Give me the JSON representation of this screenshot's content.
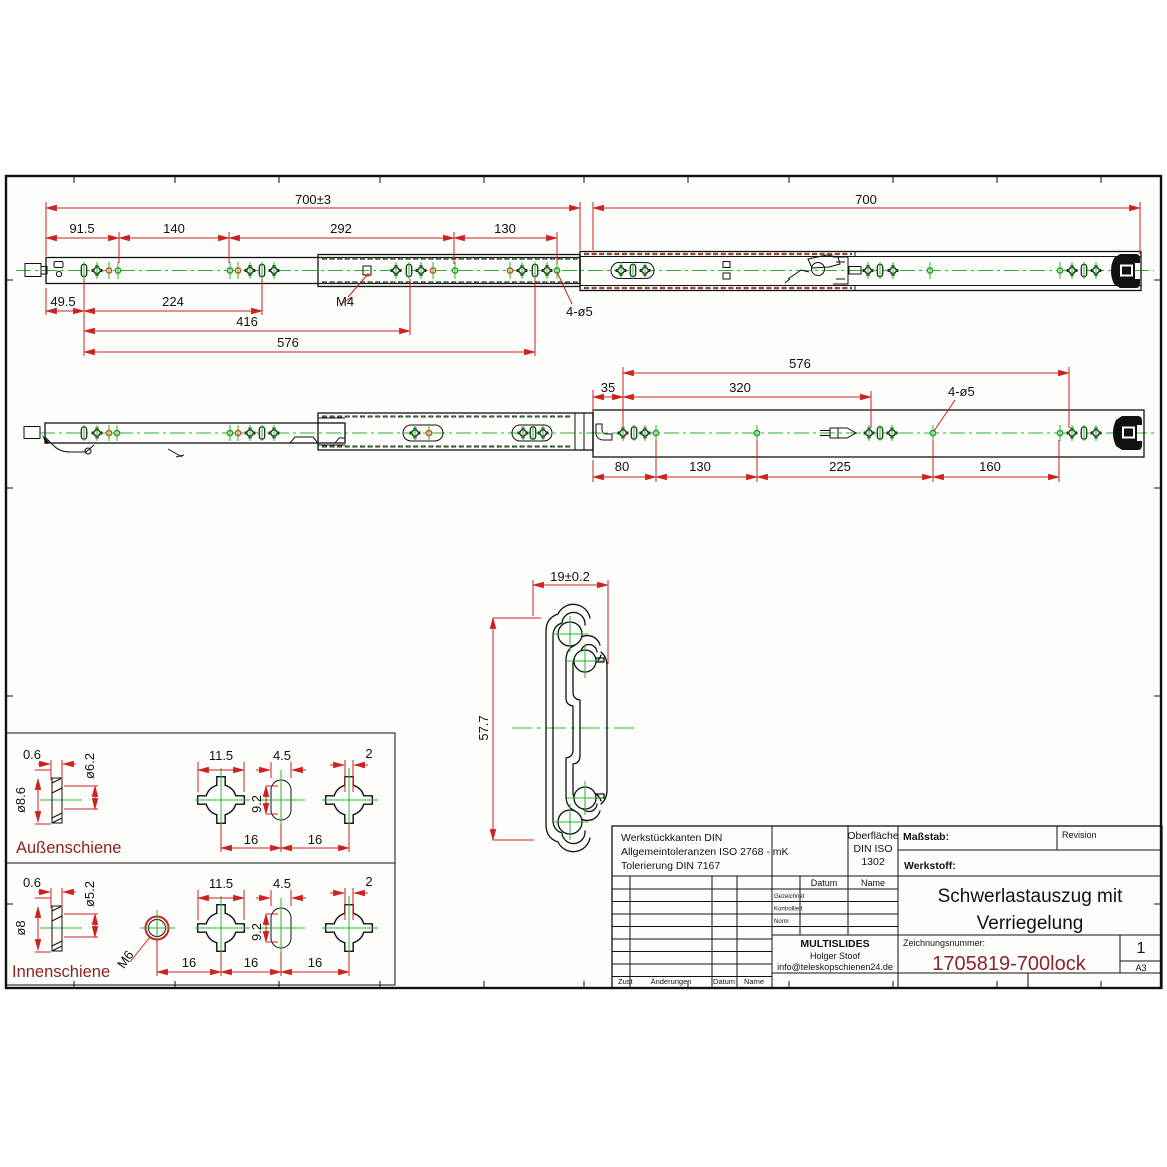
{
  "colors": {
    "dimension_red": "#cc2222",
    "centerline_green": "#2ab52a",
    "accent_maroon": "#8a2430",
    "email_teal": "#1a7f93"
  },
  "top_view": {
    "dim_total": "700±3",
    "dim_travel": "700",
    "seg1": "91.5",
    "seg2": "140",
    "seg3": "292",
    "seg4": "130",
    "low1": "49.5",
    "low2": "224",
    "low3": "416",
    "low4": "576",
    "thread_label": "M4",
    "holes_label": "4-ø5"
  },
  "mid_view": {
    "dim_576": "576",
    "dim_35": "35",
    "dim_320": "320",
    "holes_label": "4-ø5",
    "b80": "80",
    "b130": "130",
    "b225": "225",
    "b160": "160"
  },
  "section_view": {
    "width_dim": "19±0.2",
    "height_dim": "57.7"
  },
  "detail_aussen": {
    "label": "Außenschiene",
    "t06": "0.6",
    "d62": "ø6.2",
    "d86": "ø8.6",
    "w115": "11.5",
    "w45": "4.5",
    "w2": "2",
    "h92": "9.2",
    "s16a": "16",
    "s16b": "16"
  },
  "detail_innen": {
    "label": "Innenschiene",
    "t06": "0.6",
    "d52": "ø5.2",
    "d8": "ø8",
    "m6": "M6",
    "w115": "11.5",
    "w45": "4.5",
    "w2": "2",
    "h92": "9.2",
    "s16a": "16",
    "s16b": "16",
    "s16c": "16"
  },
  "title_block": {
    "tol1": "Werkstückkanten DIN",
    "tol2": "Allgemeintoleranzen ISO 2768 - mK",
    "tol3": "Tolerierung DIN 7167",
    "surf1": "Oberfläche",
    "surf2": "DIN ISO",
    "surf3": "1302",
    "masstab_label": "Maßstab:",
    "revision_label": "Revision",
    "werkstoff_label": "Werkstoff:",
    "datum_label": "Datum",
    "name_label": "Name",
    "row_gezeichnet": "Gezeichnet",
    "row_kontrolliert": "Kontrolliert",
    "row_norm": "Norm",
    "title_line1": "Schwerlastauszug mit",
    "title_line2": "Verriegelung",
    "company": "MULTISLIDES",
    "author": "Holger Stoof",
    "email": "info@teleskopschienen24.de",
    "zeichnungsnummer_label": "Zeichnungsnummer:",
    "drawing_number": "1705819-700lock",
    "sheet_number": "1",
    "paper_format": "A3",
    "zust_label": "Zust",
    "aenderungen_label": "Änderungen",
    "datum2_label": "Datum",
    "name2_label": "Name"
  }
}
